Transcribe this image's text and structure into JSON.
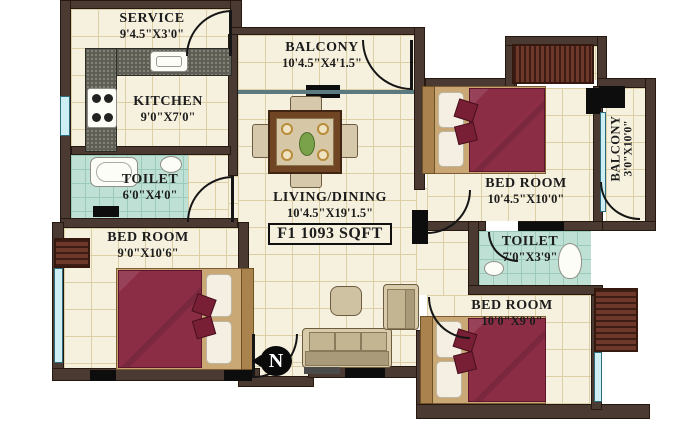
{
  "plan": {
    "compass_label": "N",
    "area_box": "F1 1093 SQFT",
    "rooms": {
      "service": {
        "name": "SERVICE",
        "dims": "9'4.5\"X3'0\""
      },
      "balcony_top": {
        "name": "BALCONY",
        "dims": "10'4.5\"X4'1.5\""
      },
      "kitchen": {
        "name": "KITCHEN",
        "dims": "9'0\"X7'0\""
      },
      "toilet_left": {
        "name": "TOILET",
        "dims": "6'0\"X4'0\""
      },
      "bedroom_left": {
        "name": "BED ROOM",
        "dims": "9'0\"X10'6\""
      },
      "living_dining": {
        "name": "LIVING/DINING",
        "dims": "10'4.5\"X19'1.5\""
      },
      "bedroom_top_right": {
        "name": "BED ROOM",
        "dims": "10'4.5\"X10'0\""
      },
      "balcony_right": {
        "name": "BALCONY",
        "dims": "3'0\"X10'0\""
      },
      "toilet_right": {
        "name": "TOILET",
        "dims": "7'0\"X3'9\""
      },
      "bedroom_bottom_right": {
        "name": "BED ROOM",
        "dims": "10'0\"X9'0\""
      }
    },
    "colors": {
      "wall": "#4b3a31",
      "floor": "#f6f1de",
      "toilet_floor": "#bfe0d4",
      "bed_blanket": "#8b2d45",
      "wardrobe": "#6e392b",
      "window": "#2e6b7c",
      "label_text": "#1c1c1c"
    }
  }
}
